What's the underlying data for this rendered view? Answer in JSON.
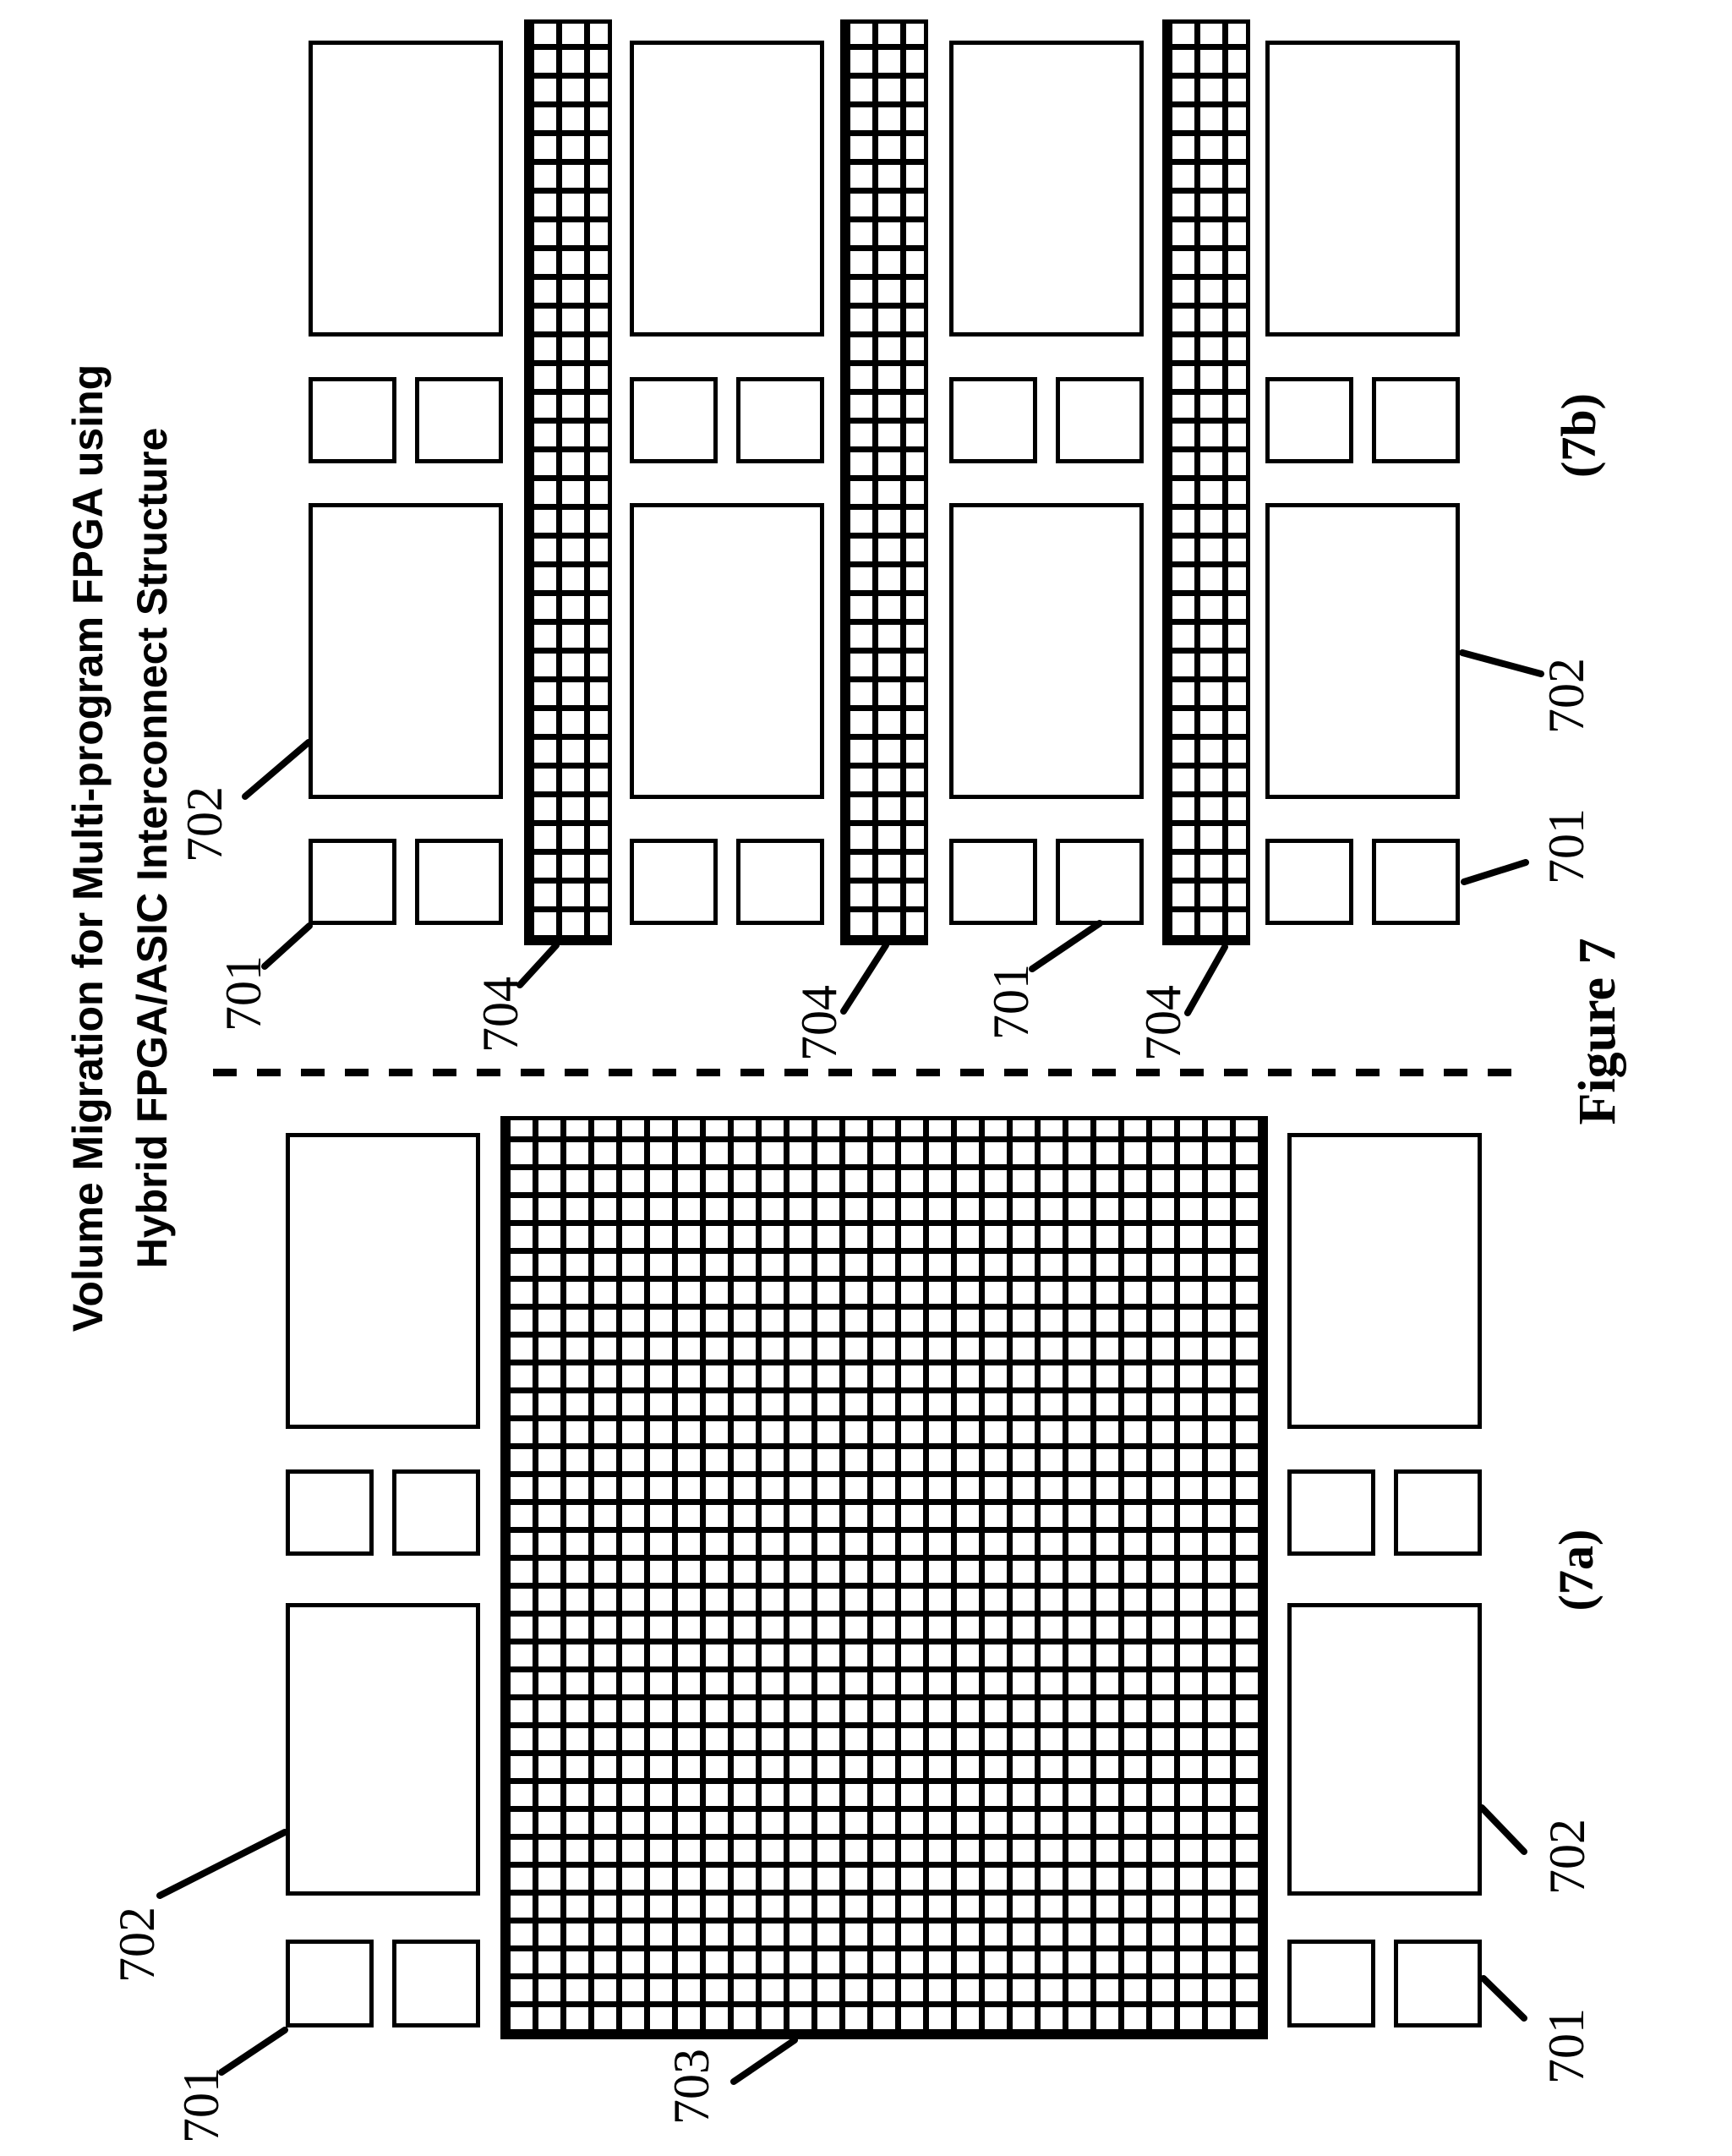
{
  "title": {
    "line1": "Volume Migration for Multi-program FPGA using",
    "line2": "Hybrid FPGA/ASIC Interconnect Structure"
  },
  "caption": "Figure 7",
  "panels": {
    "a": {
      "label": "(7a)"
    },
    "b": {
      "label": "(7b)"
    }
  },
  "refs": {
    "701": "701",
    "702": "702",
    "703": "703",
    "704": "704"
  }
}
